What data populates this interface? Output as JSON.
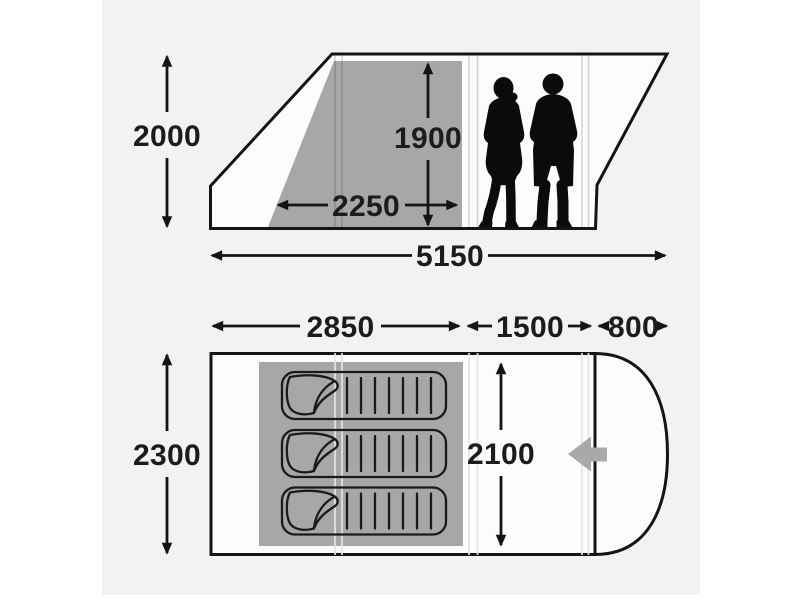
{
  "side_view": {
    "overall_height": "2000",
    "interior_height": "1900",
    "bedroom_length": "2250",
    "overall_length": "5150",
    "people_count": 2
  },
  "floor_plan": {
    "bedroom_length": "2850",
    "living_area_length": "1500",
    "canopy_depth": "800",
    "overall_width": "2300",
    "interior_width": "2100",
    "sleeping_bag_count": 3,
    "entrance_arrow_direction": "left"
  },
  "colors": {
    "canvas": "#f2f2f1",
    "interior": "#fcfcfb",
    "outline": "#141414",
    "shade": "#a8a7a5",
    "silhouette": "#0b0b0b",
    "entry": "#a9a9a9",
    "label": "#1c1c1c"
  }
}
